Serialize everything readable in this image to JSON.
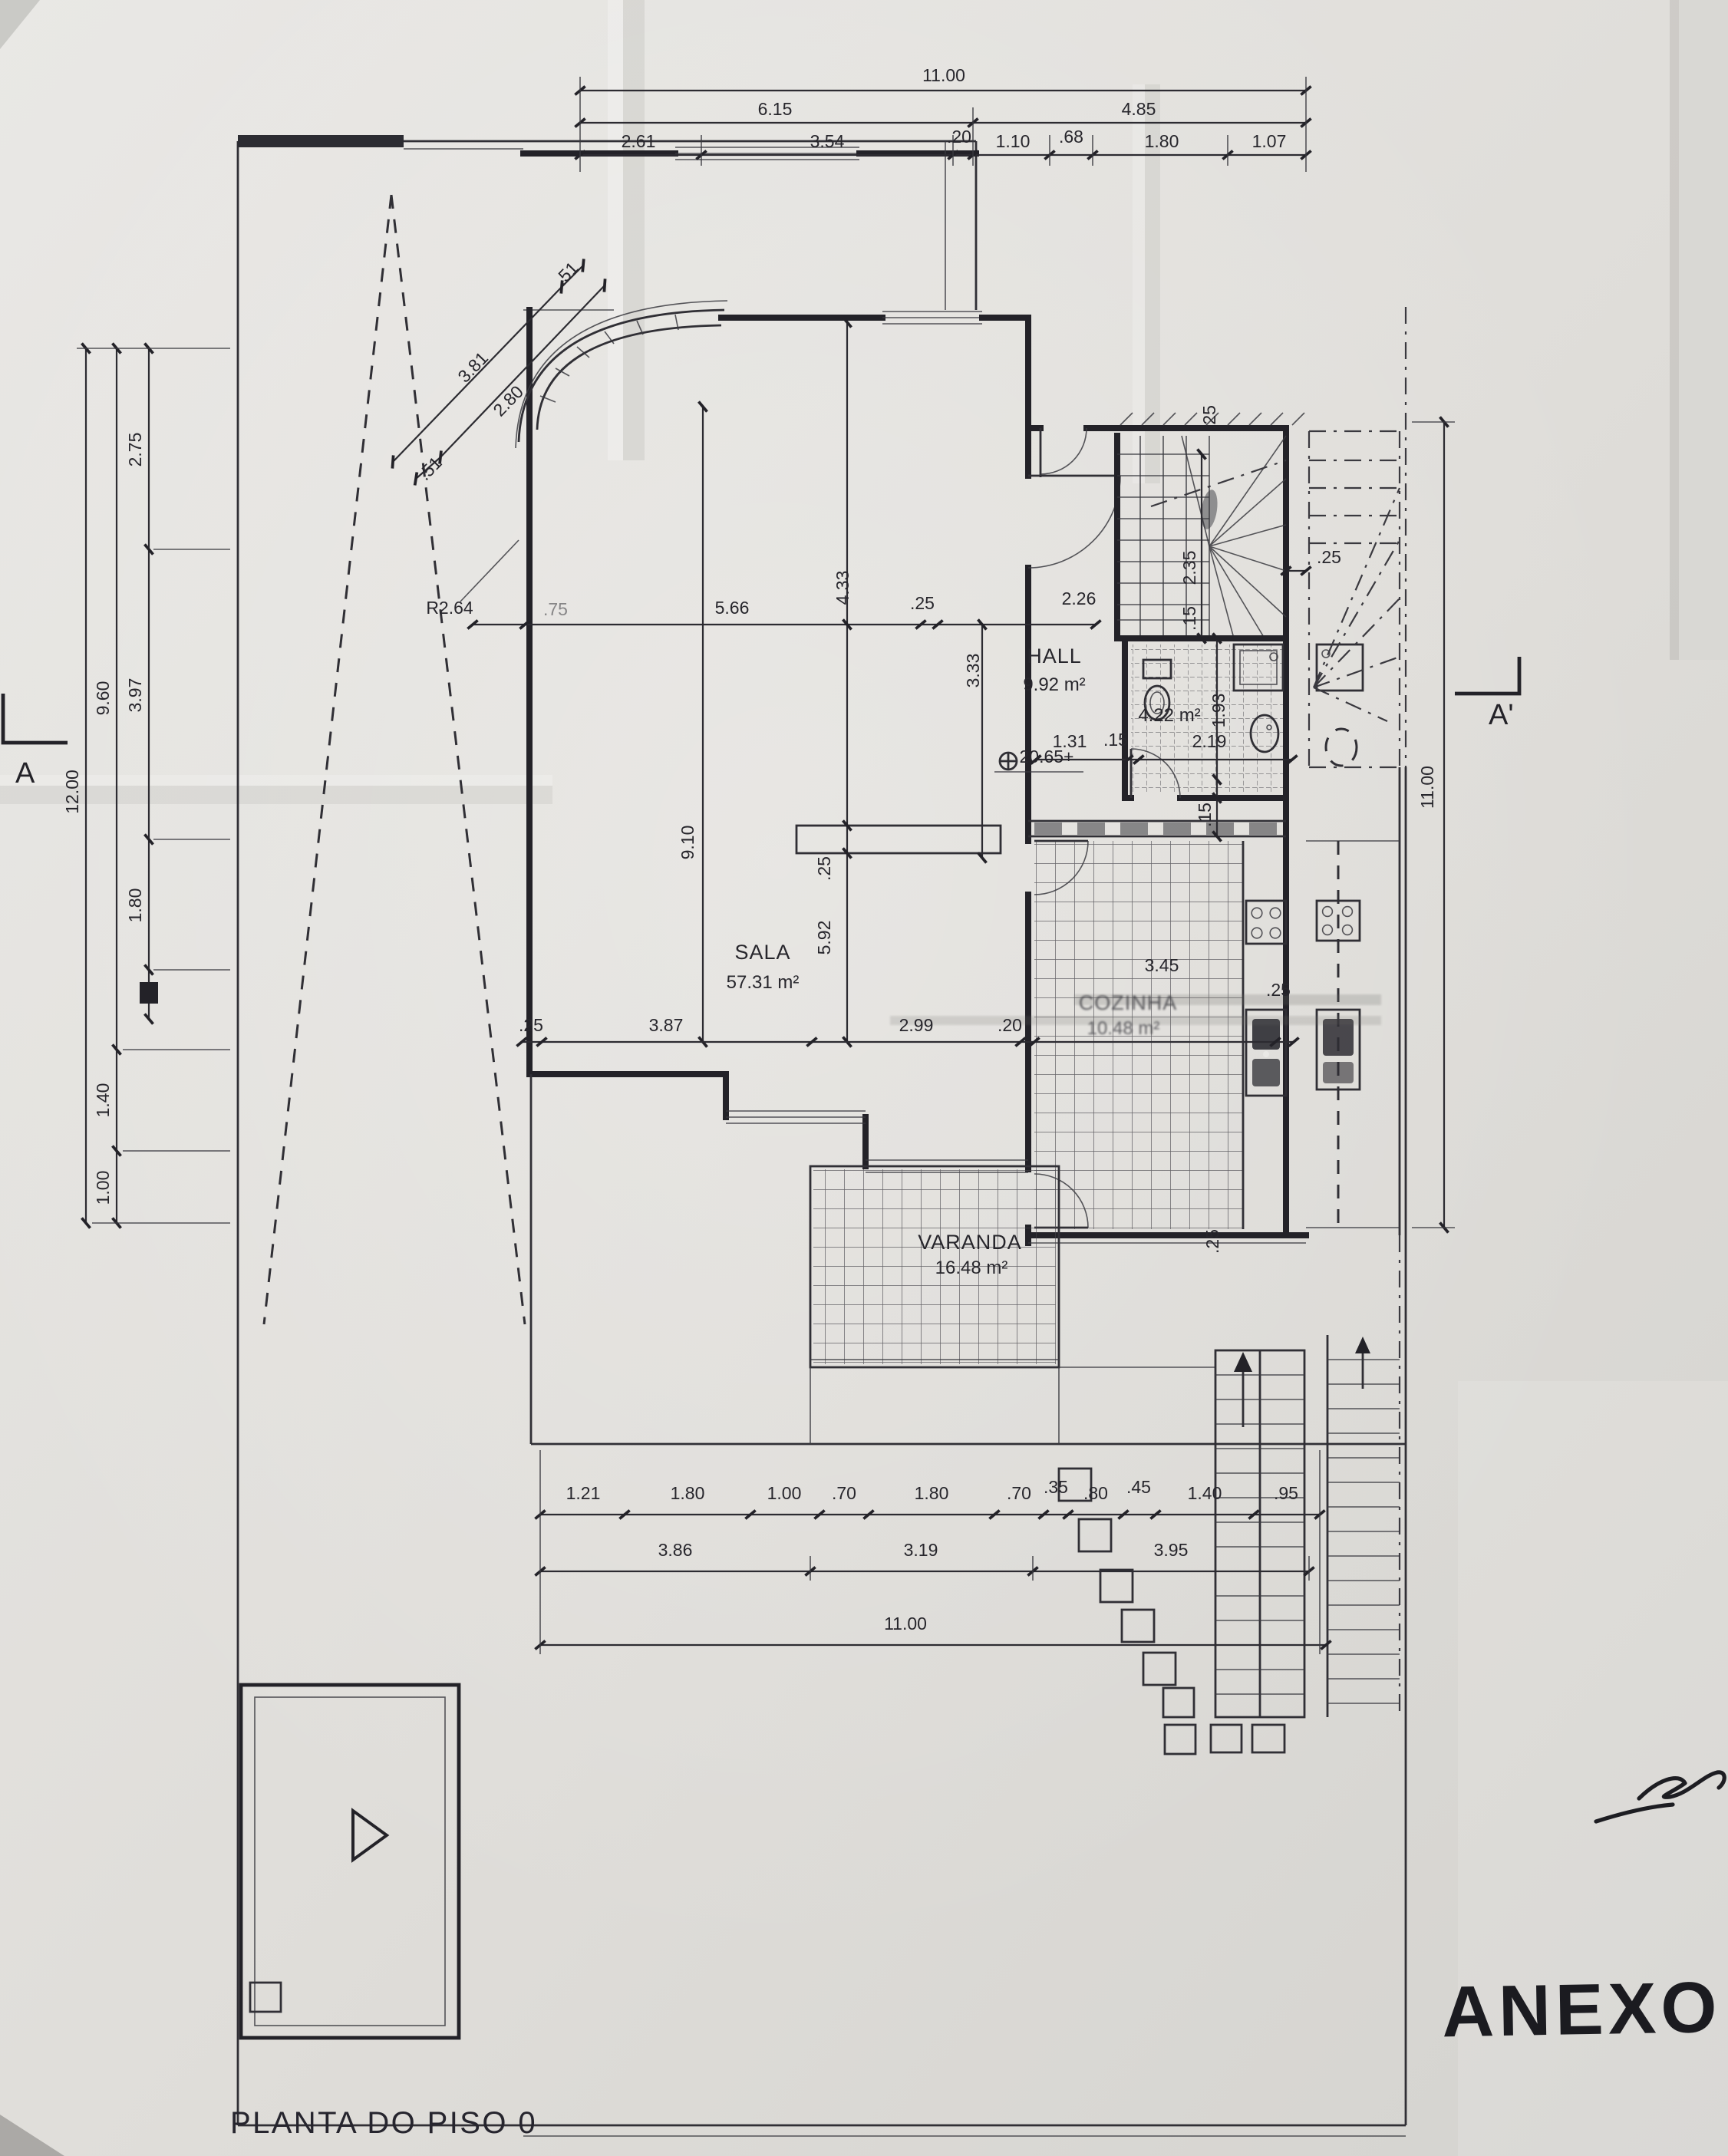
{
  "document": {
    "title": "PLANTA DO PISO 0",
    "handwritten_note": "ANEXO"
  },
  "markers": {
    "section_left": "A",
    "section_right": "A'",
    "level": "20.65+",
    "radius": "R2.64"
  },
  "rooms": {
    "sala": {
      "name": "SALA",
      "area": "57.31 m²"
    },
    "hall": {
      "name": "HALL",
      "area": "9.92 m²"
    },
    "cozinha": {
      "name": "COZINHA",
      "area": "10.48 m²"
    },
    "varanda": {
      "name": "VARANDA",
      "area": "16.48 m²"
    },
    "wc": {
      "area": "4.22 m²"
    }
  },
  "dims": {
    "top1": [
      "11.00"
    ],
    "top2": [
      "6.15",
      "4.85"
    ],
    "top3": [
      "2.61",
      "3.54",
      ".20",
      "1.10",
      ".68",
      "1.80",
      "1.07"
    ],
    "left_outer": [
      "12.00"
    ],
    "left_mid": [
      "9.60",
      "1.40",
      "1.00"
    ],
    "left_inner": [
      "2.75",
      "3.97",
      "1.80"
    ],
    "diag": [
      ".51",
      "3.81",
      "2.80",
      ".51"
    ],
    "sala_top": [
      ".75",
      "5.66",
      "4.33",
      ".25",
      "2.26",
      "3.33"
    ],
    "sala_inner": [
      "9.10",
      ".25",
      "5.92"
    ],
    "mid": [
      ".25",
      "3.87",
      "2.99",
      ".20",
      "3.45",
      ".25"
    ],
    "stair": [
      ".25",
      "2.35",
      ".15",
      ".25"
    ],
    "bath": [
      "1.31",
      ".15",
      "2.19",
      "1.93",
      ".15"
    ],
    "kitchen": [
      ".25",
      "11.00"
    ],
    "bottom1": [
      "1.21",
      "1.80",
      "1.00",
      ".70",
      "1.80",
      ".70",
      ".35",
      ".80",
      ".45",
      "1.40",
      ".95"
    ],
    "bottom2": [
      "3.86",
      "3.19",
      "3.95"
    ],
    "bottom3": [
      "11.00"
    ]
  }
}
